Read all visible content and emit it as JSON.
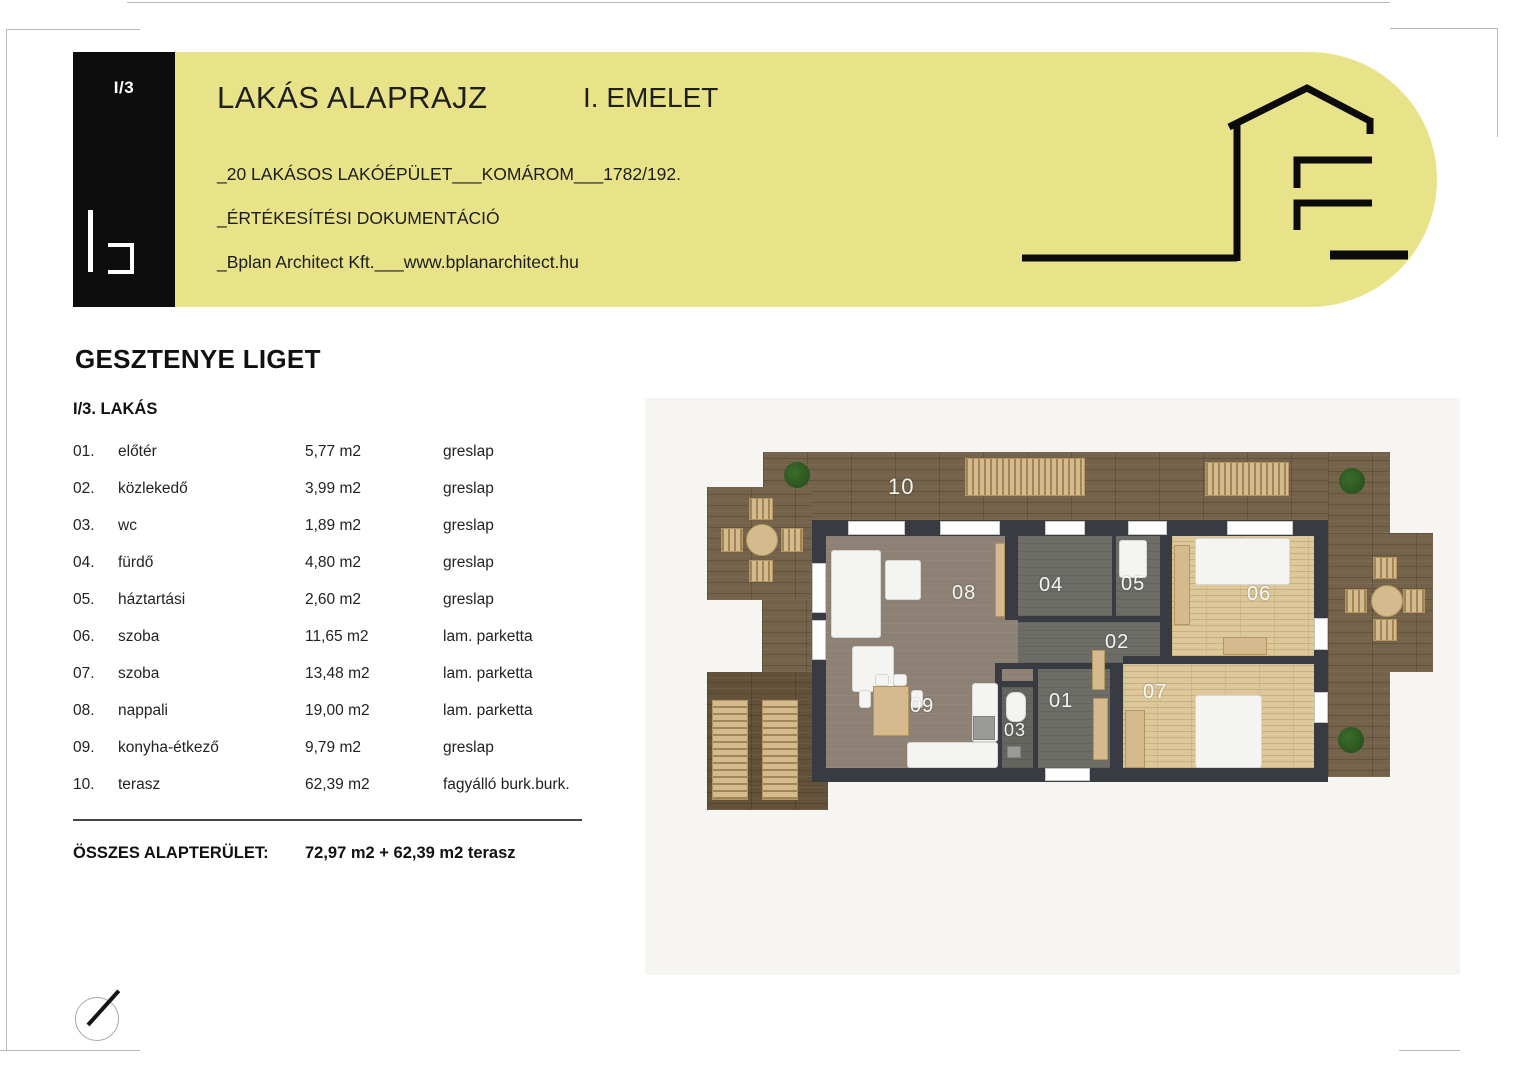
{
  "header": {
    "sheet_no": "I/3",
    "title": "LAKÁS ALAPRAJZ",
    "floor": "I. EMELET",
    "project_line": "_20 LAKÁSOS LAKÓÉPÜLET___KOMÁROM___1782/192.",
    "doc_line": "_ÉRTÉKESÍTÉSI DOKUMENTÁCIÓ",
    "company_line": "_Bplan Architect Kft.___www.bplanarchitect.hu"
  },
  "project": {
    "name": "GESZTENYE LIGET",
    "unit": "I/3. LAKÁS"
  },
  "room_table": {
    "rows": [
      {
        "no": "01.",
        "name": "előtér",
        "area": "5,77 m2",
        "finish": "greslap"
      },
      {
        "no": "02.",
        "name": "közlekedő",
        "area": "3,99 m2",
        "finish": "greslap"
      },
      {
        "no": "03.",
        "name": "wc",
        "area": "1,89 m2",
        "finish": "greslap"
      },
      {
        "no": "04.",
        "name": "fürdő",
        "area": "4,80 m2",
        "finish": "greslap"
      },
      {
        "no": "05.",
        "name": "háztartási",
        "area": "2,60 m2",
        "finish": "greslap"
      },
      {
        "no": "06.",
        "name": "szoba",
        "area": "11,65 m2",
        "finish": "lam. parketta"
      },
      {
        "no": "07.",
        "name": "szoba",
        "area": "13,48 m2",
        "finish": "lam. parketta"
      },
      {
        "no": "08.",
        "name": "nappali",
        "area": "19,00 m2",
        "finish": "lam. parketta"
      },
      {
        "no": "09.",
        "name": "konyha-étkező",
        "area": "9,79 m2",
        "finish": "greslap"
      },
      {
        "no": "10.",
        "name": "terasz",
        "area": "62,39 m2",
        "finish": "fagyálló burk.burk."
      }
    ]
  },
  "total": {
    "label": "ÖSSZES ALAPTERÜLET:",
    "value": "72,97 m2 + 62,39 m2 terasz"
  },
  "plan": {
    "labels": {
      "r01": "01",
      "r02": "02",
      "r03": "03",
      "r04": "04",
      "r05": "05",
      "r06": "06",
      "r07": "07",
      "r08": "08",
      "r09": "09",
      "r10": "10"
    }
  },
  "colors": {
    "banner_yellow": "#e8e388",
    "tab_black": "#0d0d0d",
    "wall_dark": "#383b41",
    "terrace_wood": "#74624a",
    "floor_gray_brown": "#8c8174",
    "floor_dark_gray": "#6d6c66",
    "floor_light_wood": "#dcc89b"
  }
}
